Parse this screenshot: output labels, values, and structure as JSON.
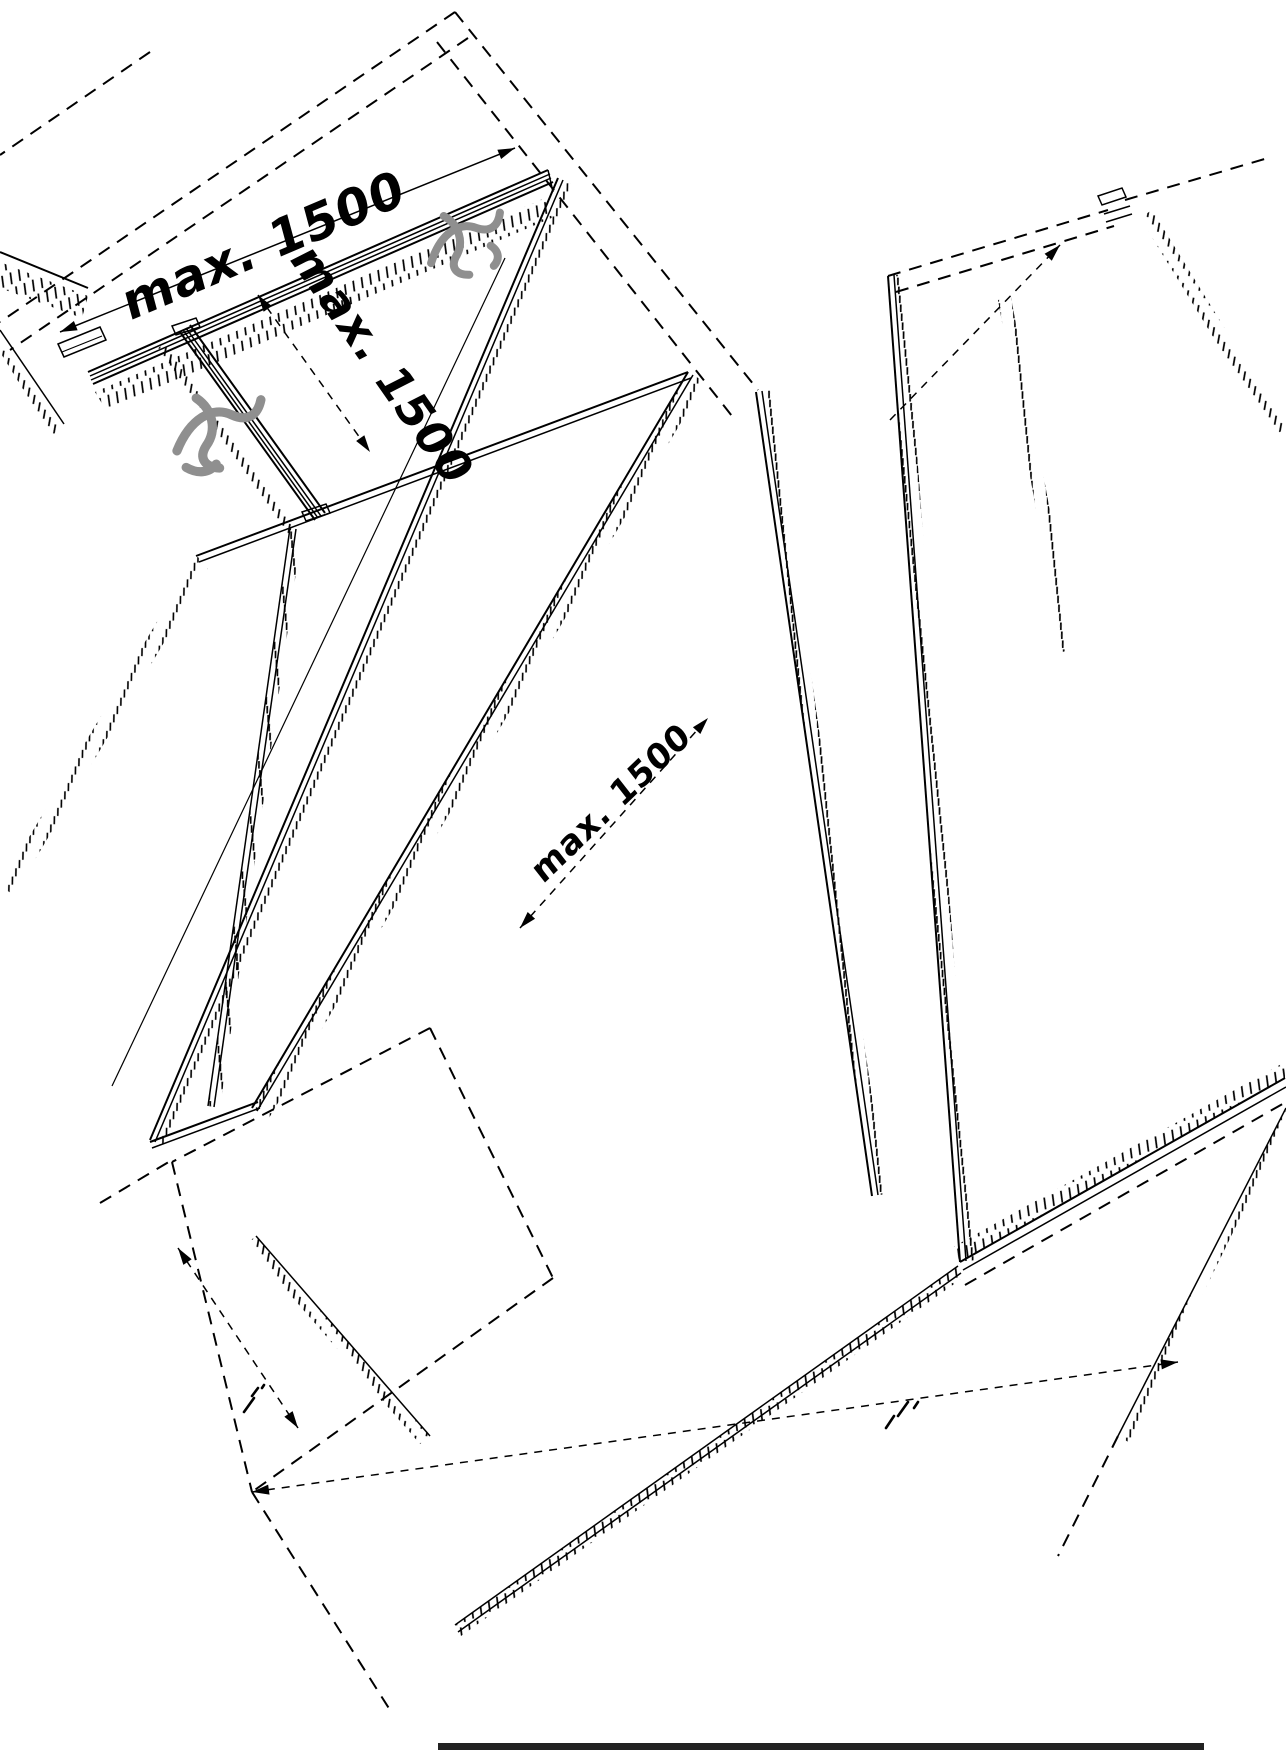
{
  "figure": {
    "type": "isometric-installation-drawing",
    "background_color": "#ffffff",
    "line_color": "#000000",
    "fastener_color": "#8f8f8f",
    "bottom_bar_color": "#222222",
    "dimensions": {
      "top_rail_spacing": "max. 1500",
      "side_rail_spacing": "max. 1500",
      "diagonal_spacing": "max. 1500"
    }
  }
}
